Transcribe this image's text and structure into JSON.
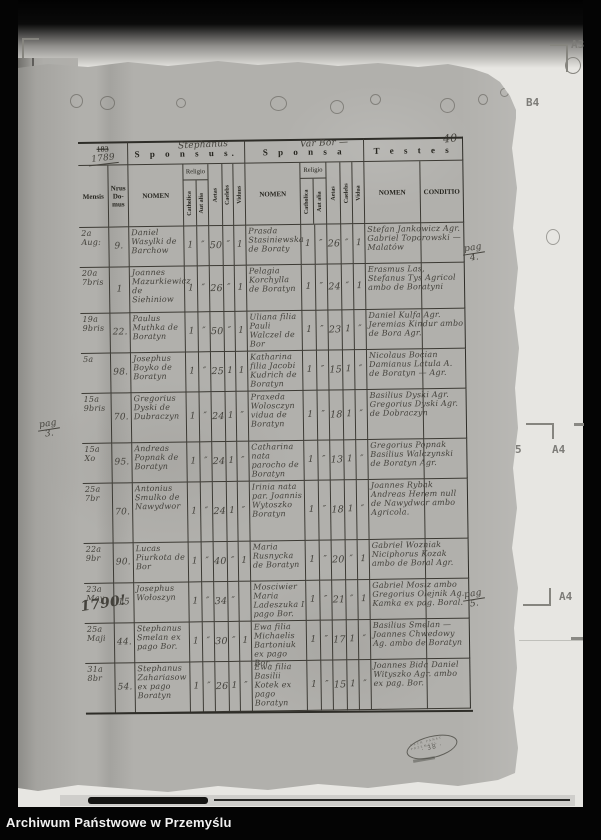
{
  "frame": {
    "archive_label": "Archiwum Państwowe w Przemyślu"
  },
  "marks": {
    "a3": "A3",
    "b4": "B4",
    "five": "5",
    "a4_upper": "A4",
    "a4_lower": "A4"
  },
  "page": {
    "page_number_hand": "40",
    "margin_notes": {
      "pag3": {
        "l1": "pag",
        "l2": "3."
      },
      "pag4": {
        "l1": "pag",
        "l2": "4."
      },
      "pag5": {
        "l1": "pag",
        "l2": "5."
      }
    },
    "stamp": {
      "center": "· 38 ·",
      "arc": "ARCH PANST PRZEMYSL"
    },
    "header": {
      "year_printed": "183",
      "year_hand": "1789",
      "sections": [
        "S p o n s u s.",
        "S p o n s a",
        "T e s t e s"
      ],
      "cols": {
        "mensis": "Mensis",
        "nrus": "Nrus Do- mus",
        "nomen": "NOMEN",
        "religio": "Religio",
        "catholica": "Catholica",
        "aut_alia": "Aut alia",
        "aetas": "Aetas",
        "caelebs": "Caelebs",
        "viduus": "Viduus",
        "vidua": "Vidua",
        "conditio": "CONDITIO"
      }
    },
    "rows": [
      {
        "mensis": "2a Aug:",
        "nrus": "9.",
        "sponsus_nomen": "Daniel Wasylki de Barchow",
        "sp_cath": "1",
        "sp_aut": "″",
        "sp_aetas": "50",
        "sp_caelebs": "″",
        "sp_viduus": "1",
        "sponsa_nomen": "Prasda Stasiniewska de Boraty",
        "sa_cath": "1",
        "sa_aut": "″",
        "sa_aetas": "26",
        "sa_caelebs": "″",
        "sa_vidua": "1",
        "testes": "Stefan Jankowicz Agr. Gabriel Toporowski — Malatów"
      },
      {
        "mensis": "20a 7bris",
        "nrus": "1",
        "sponsus_nomen": "Joannes Mazurkiewicz de Siehiniow",
        "sp_cath": "1",
        "sp_aut": "″",
        "sp_aetas": "26",
        "sp_caelebs": "″",
        "sp_viduus": "1",
        "sponsa_nomen": "Pelagia Korchylla de Boratyn",
        "sa_cath": "1",
        "sa_aut": "″",
        "sa_aetas": "24",
        "sa_caelebs": "″",
        "sa_vidua": "1",
        "testes": "Erasmus Las, Stefanus Tys Agricol ambo de Boratyni"
      },
      {
        "mensis": "19a 9bris",
        "nrus": "22.",
        "sponsus_nomen": "Paulus Muthka de Boratyn",
        "sp_cath": "1",
        "sp_aut": "″",
        "sp_aetas": "50",
        "sp_caelebs": "″",
        "sp_viduus": "1",
        "sponsa_nomen": "Uliana filia Pauli Walczel de Bor",
        "sa_cath": "1",
        "sa_aut": "″",
        "sa_aetas": "23",
        "sa_caelebs": "1",
        "sa_vidua": "″",
        "testes": "Daniel Kulfa Agr. Jeremias Kindur ambo de Bora Agr."
      },
      {
        "mensis": "5a",
        "nrus": "98.",
        "sponsus_nomen": "Josephus Boyko de Boratyn",
        "sp_cath": "1",
        "sp_aut": "″",
        "sp_aetas": "25",
        "sp_caelebs": "1",
        "sp_viduus": "1",
        "sponsa_nomen": "Katharina filia Jacobi Kudrich de Boratyn",
        "sa_cath": "1",
        "sa_aut": "″",
        "sa_aetas": "15",
        "sa_caelebs": "1",
        "sa_vidua": "″",
        "testes": "Nicolaus Bocian Damianus Latula A. de Boratyn — Agr."
      },
      {
        "mensis": "15a 9bris",
        "nrus": "70.",
        "sponsus_nomen": "Gregorius Dyski de Dubraczyn",
        "sp_cath": "1",
        "sp_aut": "″",
        "sp_aetas": "24",
        "sp_caelebs": "1",
        "sp_viduus": "″",
        "sponsa_nomen": "Praxeda Wolosczyn vidua de Boratyn",
        "sa_cath": "1",
        "sa_aut": "″",
        "sa_aetas": "18",
        "sa_caelebs": "1",
        "sa_vidua": "″",
        "testes": "Basilius Dyski Agr. Gregorius Dyski Agr. de Dobraczyn"
      },
      {
        "mensis": "15a Xo",
        "nrus": "95.",
        "sponsus_nomen": "Andreas Popnak de Boratyn",
        "sp_cath": "1",
        "sp_aut": "″",
        "sp_aetas": "24",
        "sp_caelebs": "1",
        "sp_viduus": "″",
        "sponsa_nomen": "Catharina nata parocho de Boratyn",
        "sa_cath": "1",
        "sa_aut": "″",
        "sa_aetas": "13",
        "sa_caelebs": "1",
        "sa_vidua": "″",
        "testes": "Gregorius Popnak Basilius Walczynski de Boratyn Agr."
      },
      {
        "mensis": "25a 7br",
        "nrus": "70.",
        "sponsus_nomen": "Antonius Smulko de Nawydwor",
        "sp_cath": "1",
        "sp_aut": "″",
        "sp_aetas": "24",
        "sp_caelebs": "1",
        "sp_viduus": "″",
        "sponsa_nomen": "Irinia nata par. Joannis Wytoszko Boratyn",
        "sa_cath": "1",
        "sa_aut": "″",
        "sa_aetas": "18",
        "sa_caelebs": "1",
        "sa_vidua": "″",
        "testes": "Joannes Rybak Andreas Herem null de Nawydwor ambo Agricola."
      },
      {
        "mensis": "22a 9br",
        "nrus": "90.",
        "sponsus_nomen": "Lucas Piurkota de Bor",
        "sp_cath": "1",
        "sp_aut": "″",
        "sp_aetas": "40",
        "sp_caelebs": "″",
        "sp_viduus": "1",
        "sponsa_nomen": "Maria Rusnycka de Boratyn",
        "sa_cath": "1",
        "sa_aut": "″",
        "sa_aetas": "20",
        "sa_caelebs": "″",
        "sa_vidua": "1",
        "testes": "Gabriel Wozniak Niciphorus Kozak ambo de Boral Agr."
      },
      {
        "mensis": "23a May",
        "year_big": "1790!",
        "nrus": "15",
        "sponsus_nomen": "Josephus Wołoszyn",
        "overwrite_sp": "Stephanus",
        "sp_cath": "1",
        "sp_aut": "″",
        "sp_aetas": "34",
        "sp_caelebs": "″",
        "sp_viduus": "",
        "sponsa_nomen": "Mosciwier Maria Ladeszuka I pago Bor.",
        "overwrite_sa": "Var Bor —",
        "sa_cath": "1",
        "sa_aut": "″",
        "sa_aetas": "21",
        "sa_caelebs": "″",
        "sa_vidua": "1",
        "testes": "Gabriel Mosiz ambo Gregorius Olejnik Ag. Kamka ex pag. Boral."
      },
      {
        "mensis": "25a Maji",
        "nrus": "44.",
        "sponsus_nomen": "Stephanus Smelan ex pago Bor.",
        "sp_cath": "1",
        "sp_aut": "″",
        "sp_aetas": "30",
        "sp_caelebs": "″",
        "sp_viduus": "1",
        "sponsa_nomen": "Ewa filia Michaelis Bartoniuk ex pago Bor.",
        "sa_cath": "1",
        "sa_aut": "″",
        "sa_aetas": "17",
        "sa_caelebs": "1",
        "sa_vidua": "″",
        "testes": "Basilius Smelan — Joannes Chwedowy Ag. ambo de Boratyn"
      },
      {
        "mensis": "31a 8br",
        "nrus": "54.",
        "sponsus_nomen": "Stephanus Zahariasow ex pago Boratyn",
        "sp_cath": "1",
        "sp_aut": "″",
        "sp_aetas": "26",
        "sp_caelebs": "1",
        "sp_viduus": "″",
        "sponsa_nomen": "Ewa filia Basilii Kotek ex pago Boratyn",
        "sa_cath": "1",
        "sa_aut": "″",
        "sa_aetas": "15",
        "sa_caelebs": "1",
        "sa_vidua": "″",
        "testes": "Joannes Bida Daniel Wityszko Agr. ambo ex pag. Bor."
      }
    ]
  },
  "prev_page_fragments": [
    "10",
    "h",
    "lo",
    "br.",
    "11",
    "bowl",
    "haily",
    "a Bar",
    "lo.",
    "wek",
    "amb.",
    "y la",
    "r. amb",
    "anca Ag.",
    "Boral",
    "S",
    "42: D.B.",
    "Agricol"
  ]
}
